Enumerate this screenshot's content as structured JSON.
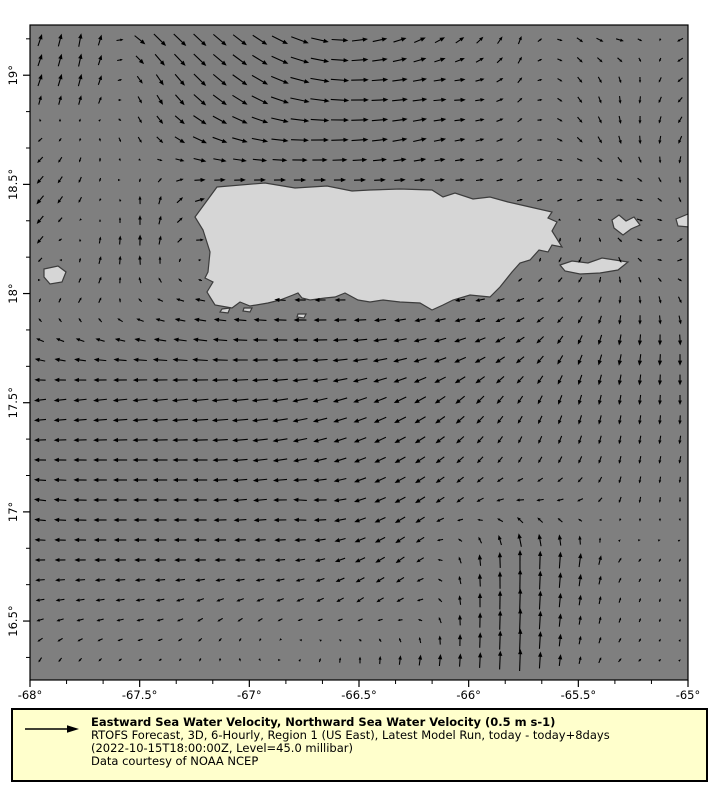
{
  "window": {
    "width": 720,
    "height": 800,
    "background": "#ffffff"
  },
  "legend": {
    "title": "Eastward Sea Water Velocity, Northward Sea Water Velocity (0.5 m s-1)",
    "line2": "RTOFS Forecast, 3D, 6-Hourly, Region 1 (US East), Latest Model Run, today - today+8days",
    "line3": "(2022-10-15T18:00:00Z, Level=45.0 millibar)",
    "line4": "Data courtesy of NOAA NCEP",
    "reference_value": "0.5 m s-1",
    "background": "#ffffcc",
    "border_color": "#000000"
  },
  "map": {
    "plot_area_px": {
      "left": 30,
      "top": 25,
      "right": 688,
      "bottom": 680
    },
    "colors": {
      "ocean": "#7f7f7f",
      "land": "#d6d6d6",
      "coastline": "#3c3c3c",
      "frame": "#000000",
      "arrow": "#000000",
      "tick_text": "#000000"
    },
    "lon_min": -68,
    "lon_max": -65,
    "lat_top": 19.23,
    "lat_bottom": 16.23,
    "x_axis": {
      "ticks": [
        {
          "label": "-68°",
          "lon": -68
        },
        {
          "label": "-67.5°",
          "lon": -67.5
        },
        {
          "label": "-67°",
          "lon": -67
        },
        {
          "label": "-66.5°",
          "lon": -66.5
        },
        {
          "label": "-66°",
          "lon": -66
        },
        {
          "label": "-65.5°",
          "lon": -65.5
        },
        {
          "label": "-65°",
          "lon": -65
        }
      ],
      "minor_per_major": 3
    },
    "y_axis": {
      "ticks": [
        {
          "label": "19°",
          "lat": 19
        },
        {
          "label": "18.5°",
          "lat": 18.5
        },
        {
          "label": "18°",
          "lat": 18
        },
        {
          "label": "17.5°",
          "lat": 17.5
        },
        {
          "label": "17°",
          "lat": 17
        },
        {
          "label": "16.5°",
          "lat": 16.5
        }
      ],
      "minor_per_major": 3
    },
    "land_polygons": {
      "puerto_rico": [
        [
          217,
          187
        ],
        [
          265,
          183
        ],
        [
          295,
          188
        ],
        [
          327,
          186
        ],
        [
          352,
          191
        ],
        [
          370,
          190
        ],
        [
          400,
          189
        ],
        [
          432,
          190
        ],
        [
          443,
          197
        ],
        [
          455,
          193
        ],
        [
          473,
          199
        ],
        [
          490,
          197
        ],
        [
          508,
          202
        ],
        [
          530,
          207
        ],
        [
          552,
          212
        ],
        [
          548,
          218
        ],
        [
          557,
          222
        ],
        [
          552,
          231
        ],
        [
          562,
          247
        ],
        [
          552,
          245
        ],
        [
          548,
          252
        ],
        [
          539,
          250
        ],
        [
          530,
          260
        ],
        [
          520,
          263
        ],
        [
          512,
          272
        ],
        [
          500,
          287
        ],
        [
          490,
          297
        ],
        [
          470,
          295
        ],
        [
          453,
          300
        ],
        [
          443,
          305
        ],
        [
          432,
          310
        ],
        [
          420,
          303
        ],
        [
          400,
          302
        ],
        [
          383,
          300
        ],
        [
          370,
          302
        ],
        [
          358,
          300
        ],
        [
          345,
          293
        ],
        [
          335,
          297
        ],
        [
          325,
          298
        ],
        [
          310,
          300
        ],
        [
          302,
          298
        ],
        [
          298,
          293
        ],
        [
          293,
          295
        ],
        [
          280,
          300
        ],
        [
          268,
          303
        ],
        [
          250,
          306
        ],
        [
          240,
          302
        ],
        [
          232,
          308
        ],
        [
          215,
          305
        ],
        [
          210,
          297
        ],
        [
          207,
          292
        ],
        [
          213,
          282
        ],
        [
          205,
          278
        ],
        [
          208,
          272
        ],
        [
          210,
          252
        ],
        [
          203,
          230
        ],
        [
          195,
          217
        ]
      ],
      "mona": [
        [
          44,
          269
        ],
        [
          58,
          266
        ],
        [
          66,
          272
        ],
        [
          62,
          282
        ],
        [
          50,
          284
        ],
        [
          44,
          277
        ]
      ],
      "vieques": [
        [
          560,
          265
        ],
        [
          572,
          261
        ],
        [
          588,
          263
        ],
        [
          602,
          258
        ],
        [
          615,
          260
        ],
        [
          628,
          262
        ],
        [
          618,
          270
        ],
        [
          600,
          273
        ],
        [
          580,
          274
        ],
        [
          565,
          271
        ]
      ],
      "culebra": [
        [
          612,
          220
        ],
        [
          619,
          215
        ],
        [
          626,
          221
        ],
        [
          634,
          217
        ],
        [
          640,
          225
        ],
        [
          631,
          229
        ],
        [
          623,
          235
        ],
        [
          614,
          228
        ]
      ],
      "st_thomas": [
        [
          676,
          219
        ],
        [
          688,
          214
        ],
        [
          689,
          227
        ],
        [
          678,
          226
        ]
      ],
      "islet_sw1": [
        [
          222,
          309
        ],
        [
          230,
          308
        ],
        [
          228,
          313
        ],
        [
          220,
          312
        ]
      ],
      "islet_sw2": [
        [
          244,
          308
        ],
        [
          252,
          308
        ],
        [
          250,
          312
        ],
        [
          243,
          311
        ]
      ],
      "islet_s3": [
        [
          298,
          314
        ],
        [
          306,
          314
        ],
        [
          304,
          318
        ],
        [
          297,
          317
        ]
      ]
    },
    "arrows": {
      "x_start": 40,
      "y_start": 40,
      "spacing": 20,
      "px_per_unit": 40
    },
    "flow_field": {
      "x0": 40,
      "dx": 53.333,
      "y0": 40,
      "dy": 51.667,
      "comment": "13x13 grid of [east,north] velocity components, ~m/s, rows top to bottom",
      "grid": [
        [
          [
            0.1,
            0.3
          ],
          [
            0.05,
            0.35
          ],
          [
            0.3,
            -0.3
          ],
          [
            0.32,
            -0.3
          ],
          [
            0.35,
            -0.25
          ],
          [
            0.45,
            -0.15
          ],
          [
            0.4,
            0.05
          ],
          [
            0.3,
            0.12
          ],
          [
            0.2,
            0.15
          ],
          [
            0.08,
            0.2
          ],
          [
            0.15,
            -0.12
          ],
          [
            0.2,
            -0.05
          ],
          [
            -0.15,
            -0.08
          ]
        ],
        [
          [
            0.1,
            0.3
          ],
          [
            0.08,
            0.3
          ],
          [
            0.1,
            -0.25
          ],
          [
            0.3,
            -0.3
          ],
          [
            0.4,
            -0.25
          ],
          [
            0.5,
            -0.1
          ],
          [
            0.45,
            0.0
          ],
          [
            0.38,
            0.05
          ],
          [
            0.28,
            0.0
          ],
          [
            0.12,
            0.12
          ],
          [
            0.12,
            -0.15
          ],
          [
            0.0,
            -0.2
          ],
          [
            -0.12,
            -0.12
          ]
        ],
        [
          [
            -0.12,
            -0.12
          ],
          [
            0.0,
            -0.1
          ],
          [
            0.1,
            -0.15
          ],
          [
            0.35,
            -0.15
          ],
          [
            0.4,
            -0.08
          ],
          [
            0.45,
            0.0
          ],
          [
            0.42,
            0.03
          ],
          [
            0.35,
            0.08
          ],
          [
            0.25,
            0.05
          ],
          [
            0.12,
            0.08
          ],
          [
            0.15,
            -0.12
          ],
          [
            0.05,
            -0.22
          ],
          [
            -0.08,
            -0.2
          ]
        ],
        [
          [
            -0.18,
            -0.22
          ],
          [
            -0.05,
            -0.15
          ],
          [
            0.0,
            0.25
          ],
          [
            0.25,
            0.08
          ],
          [
            0.25,
            0.04
          ],
          [
            0.25,
            0.0
          ],
          [
            0.25,
            0.0
          ],
          [
            0.25,
            0.0
          ],
          [
            0.2,
            0.0
          ],
          [
            0.15,
            0.05
          ],
          [
            0.15,
            0.08
          ],
          [
            0.2,
            0.0
          ],
          [
            0.05,
            -0.15
          ]
        ],
        [
          [
            -0.15,
            -0.18
          ],
          [
            0.05,
            0.2
          ],
          [
            0.0,
            0.3
          ],
          [
            0.18,
            0.0
          ],
          [
            0.18,
            -0.04
          ],
          [
            0.18,
            -0.04
          ],
          [
            0.16,
            -0.04
          ],
          [
            0.14,
            -0.04
          ],
          [
            0.12,
            -0.04
          ],
          [
            0.08,
            -0.08
          ],
          [
            -0.08,
            -0.15
          ],
          [
            0.12,
            -0.12
          ],
          [
            0.15,
            0.12
          ]
        ],
        [
          [
            0.05,
            0.1
          ],
          [
            0.1,
            0.15
          ],
          [
            -0.1,
            0.08
          ],
          [
            -0.25,
            0.05
          ],
          [
            -0.28,
            0.04
          ],
          [
            -0.28,
            0.0
          ],
          [
            -0.26,
            0.0
          ],
          [
            -0.25,
            -0.04
          ],
          [
            -0.25,
            -0.04
          ],
          [
            -0.2,
            -0.08
          ],
          [
            -0.12,
            -0.12
          ],
          [
            0.0,
            -0.2
          ],
          [
            0.08,
            -0.16
          ]
        ],
        [
          [
            -0.25,
            0.08
          ],
          [
            -0.3,
            0.05
          ],
          [
            -0.34,
            0.04
          ],
          [
            -0.38,
            0.04
          ],
          [
            -0.38,
            0.0
          ],
          [
            -0.38,
            0.0
          ],
          [
            -0.38,
            -0.04
          ],
          [
            -0.34,
            -0.08
          ],
          [
            -0.3,
            -0.12
          ],
          [
            -0.22,
            -0.16
          ],
          [
            -0.12,
            -0.25
          ],
          [
            -0.05,
            -0.3
          ],
          [
            0.0,
            -0.3
          ]
        ],
        [
          [
            -0.3,
            -0.04
          ],
          [
            -0.34,
            -0.04
          ],
          [
            -0.38,
            -0.04
          ],
          [
            -0.42,
            -0.04
          ],
          [
            -0.42,
            -0.04
          ],
          [
            -0.38,
            -0.08
          ],
          [
            -0.34,
            -0.12
          ],
          [
            -0.3,
            -0.16
          ],
          [
            -0.22,
            -0.2
          ],
          [
            -0.13,
            -0.2
          ],
          [
            -0.08,
            -0.25
          ],
          [
            -0.04,
            -0.25
          ],
          [
            0.0,
            -0.25
          ]
        ],
        [
          [
            -0.3,
            0.0
          ],
          [
            -0.34,
            0.0
          ],
          [
            -0.38,
            0.0
          ],
          [
            -0.38,
            0.0
          ],
          [
            -0.38,
            -0.04
          ],
          [
            -0.34,
            -0.08
          ],
          [
            -0.3,
            -0.12
          ],
          [
            -0.26,
            -0.16
          ],
          [
            -0.17,
            -0.17
          ],
          [
            -0.08,
            -0.17
          ],
          [
            -0.08,
            -0.2
          ],
          [
            -0.04,
            -0.2
          ],
          [
            -0.04,
            -0.2
          ]
        ],
        [
          [
            -0.3,
            0.04
          ],
          [
            -0.34,
            0.0
          ],
          [
            -0.34,
            0.0
          ],
          [
            -0.34,
            0.0
          ],
          [
            -0.34,
            -0.04
          ],
          [
            -0.34,
            0.04
          ],
          [
            -0.3,
            -0.1
          ],
          [
            -0.26,
            -0.16
          ],
          [
            -0.17,
            -0.12
          ],
          [
            -0.21,
            0.0
          ],
          [
            -0.17,
            -0.04
          ],
          [
            -0.04,
            -0.16
          ],
          [
            0.0,
            -0.12
          ]
        ],
        [
          [
            -0.26,
            0.0
          ],
          [
            -0.3,
            0.0
          ],
          [
            -0.3,
            0.0
          ],
          [
            -0.3,
            0.0
          ],
          [
            -0.26,
            0.0
          ],
          [
            -0.26,
            -0.04
          ],
          [
            -0.26,
            -0.12
          ],
          [
            -0.21,
            -0.17
          ],
          [
            -0.04,
            0.21
          ],
          [
            0.0,
            0.5
          ],
          [
            0.04,
            0.4
          ],
          [
            0.08,
            0.08
          ],
          [
            0.04,
            0.08
          ]
        ],
        [
          [
            -0.21,
            -0.04
          ],
          [
            -0.21,
            -0.04
          ],
          [
            -0.21,
            -0.04
          ],
          [
            -0.17,
            -0.08
          ],
          [
            -0.17,
            -0.08
          ],
          [
            -0.17,
            -0.08
          ],
          [
            -0.17,
            -0.12
          ],
          [
            -0.17,
            -0.08
          ],
          [
            0.0,
            0.3
          ],
          [
            0.02,
            0.6
          ],
          [
            0.04,
            0.26
          ],
          [
            0.04,
            0.12
          ],
          [
            0.0,
            0.08
          ]
        ],
        [
          [
            -0.08,
            -0.12
          ],
          [
            -0.08,
            -0.08
          ],
          [
            -0.08,
            -0.04
          ],
          [
            -0.04,
            -0.08
          ],
          [
            0.04,
            -0.08
          ],
          [
            0.04,
            0.08
          ],
          [
            0.0,
            0.17
          ],
          [
            0.04,
            0.26
          ],
          [
            0.02,
            0.34
          ],
          [
            0.02,
            0.55
          ],
          [
            0.04,
            0.21
          ],
          [
            0.08,
            0.08
          ],
          [
            0.04,
            0.04
          ]
        ]
      ]
    }
  }
}
